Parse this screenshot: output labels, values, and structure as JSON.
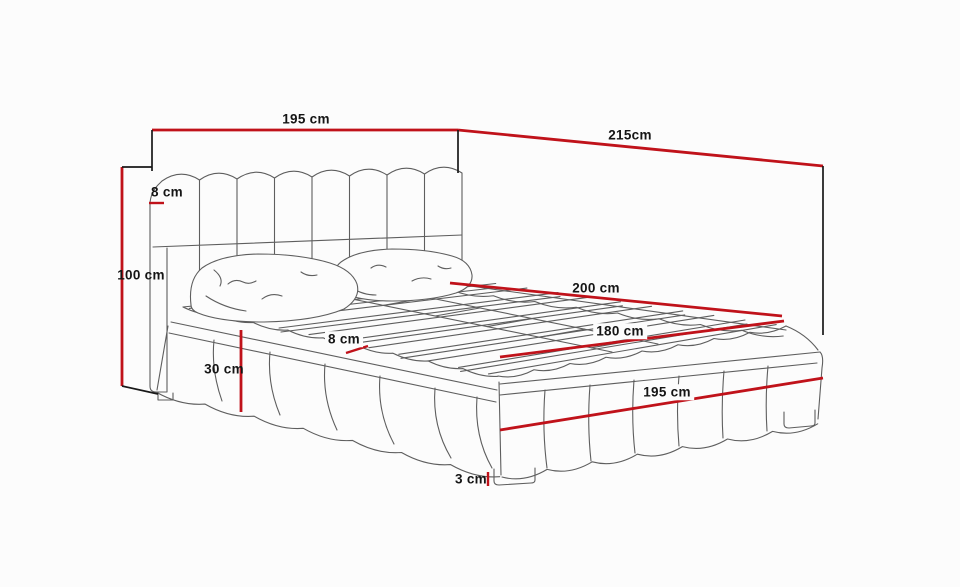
{
  "diagram": {
    "subject": "upholstered bed with slatted base - dimension drawing",
    "colors": {
      "background": "#fcfcfc",
      "dimension_line": "#c0121a",
      "extension_line": "#191919",
      "sketch_line": "#5e5e5e",
      "label_text": "#151515"
    },
    "dimensions": [
      {
        "id": "headboard-width",
        "label": "195 cm"
      },
      {
        "id": "bed-length",
        "label": "215cm"
      },
      {
        "id": "headboard-depth",
        "label": "8 cm"
      },
      {
        "id": "headboard-height",
        "label": "100 cm"
      },
      {
        "id": "slat-area-length",
        "label": "200 cm"
      },
      {
        "id": "mattress-width",
        "label": "180 cm"
      },
      {
        "id": "platform-depth",
        "label": "8 cm"
      },
      {
        "id": "base-height",
        "label": "30 cm"
      },
      {
        "id": "foot-width",
        "label": "195 cm"
      },
      {
        "id": "leg-height",
        "label": "3 cm"
      }
    ]
  }
}
